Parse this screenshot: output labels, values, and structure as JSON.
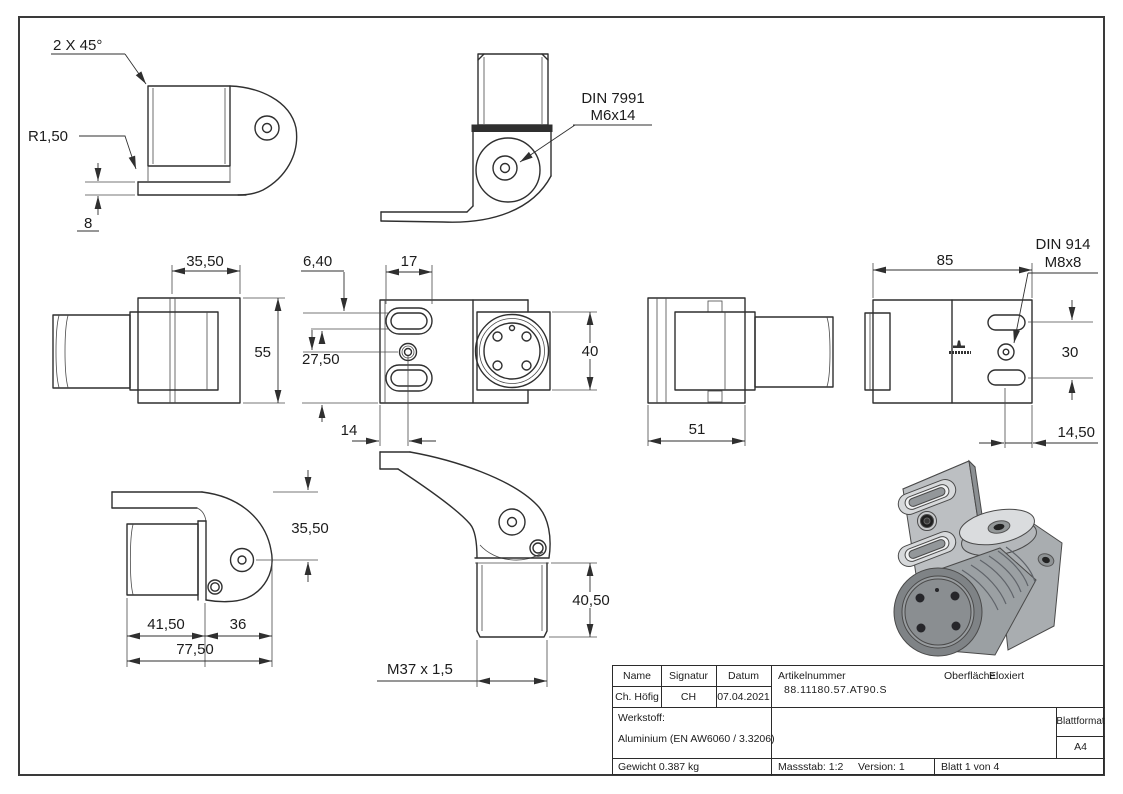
{
  "colors": {
    "line": "#2f2f2f",
    "metal_light": "#dadcde",
    "metal_mid": "#b4b7ba",
    "metal_dark": "#8a8e91",
    "hole_dark": "#222222"
  },
  "views": {
    "top_left": {
      "chamfer": "2 X 45°",
      "radius": "R1,50",
      "thickness": "8"
    },
    "top_center": {
      "fastener_line1": "DIN 7991",
      "fastener_line2": "M6x14"
    },
    "mid_left": {
      "width": "35,50",
      "height": "55"
    },
    "mid_center": {
      "slot_width": "6,40",
      "slot_length": "17",
      "hole_offset": "27,50",
      "hole_distance": "14",
      "boss_height": "40"
    },
    "mid_right": {
      "depth": "51"
    },
    "far_right": {
      "length": "85",
      "fastener_line1": "DIN 914",
      "fastener_line2": "M8x8",
      "slot_spacing": "30",
      "slot_offset": "14,50"
    },
    "bottom_left": {
      "height": "35,50",
      "cylinder_length": "41,50",
      "head_length": "36",
      "total_length": "77,50"
    },
    "bottom_center": {
      "cylinder_height": "40,50",
      "thread": "M37 x 1,5"
    }
  },
  "title_block": {
    "name_header": "Name",
    "signature_header": "Signatur",
    "date_header": "Datum",
    "article_header": "Artikelnummer",
    "surface_label": "Oberfläche:",
    "surface_value": "Eloxiert",
    "name_value": "Ch. Höfig",
    "signature_value": "CH",
    "date_value": "07.04.2021",
    "article_number": "88.11180.57.AT90.S",
    "material_label": "Werkstoff:",
    "material_value": "Aluminium (EN AW6060 / 3.3206)",
    "format_label": "Blattformat",
    "format_value": "A4",
    "weight": "Gewicht 0.387 kg",
    "scale": "Massstab: 1:2",
    "version": "Version: 1",
    "sheet": "Blatt 1 von 4"
  }
}
